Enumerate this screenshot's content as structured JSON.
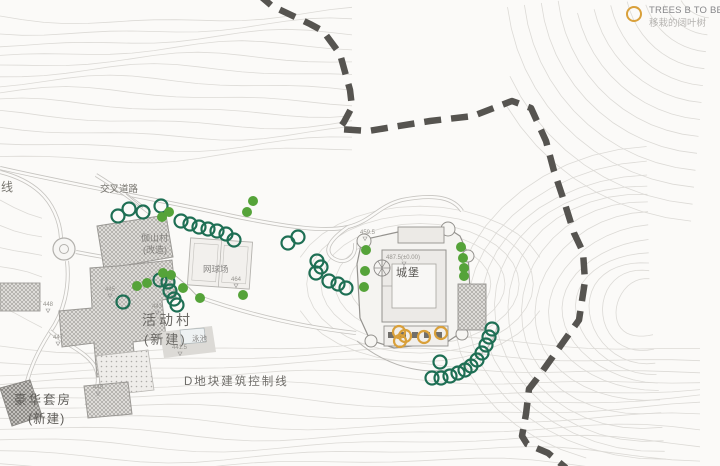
{
  "legend": {
    "tree_move": {
      "label_en": "TREES B TO BE M",
      "label_zh": "移栽的阔叶树"
    }
  },
  "colors": {
    "contour": "#dcdad6",
    "road": "#c6c4c0",
    "road_gap": "#fbfaf8",
    "boundary": "#565450",
    "tree_existing": "#55a339",
    "tree_evergreen": "#1e6f54",
    "tree_move": "#d9a03a",
    "building_stroke": "#9b9995",
    "label_gray": "#8a8886"
  },
  "map": {
    "boundary_points": [
      [
        258,
        -6
      ],
      [
        272,
        6
      ],
      [
        310,
        24
      ],
      [
        323,
        31
      ],
      [
        340,
        54
      ],
      [
        350,
        90
      ],
      [
        352,
        107
      ],
      [
        344,
        122
      ],
      [
        339,
        129
      ],
      [
        368,
        131
      ],
      [
        430,
        121
      ],
      [
        473,
        116
      ],
      [
        512,
        101
      ],
      [
        531,
        108
      ],
      [
        546,
        141
      ],
      [
        554,
        171
      ],
      [
        564,
        201
      ],
      [
        574,
        233
      ],
      [
        583,
        252
      ],
      [
        585,
        281
      ],
      [
        579,
        320
      ],
      [
        559,
        348
      ],
      [
        539,
        376
      ],
      [
        529,
        389
      ],
      [
        526,
        414
      ],
      [
        522,
        436
      ],
      [
        527,
        444
      ],
      [
        548,
        453
      ],
      [
        566,
        468
      ]
    ],
    "trees": {
      "evergreen_kept": [
        [
          118,
          216
        ],
        [
          129,
          209
        ],
        [
          143,
          212
        ],
        [
          161,
          206
        ],
        [
          181,
          221
        ],
        [
          190,
          224
        ],
        [
          199,
          227
        ],
        [
          208,
          229
        ],
        [
          217,
          231
        ],
        [
          226,
          234
        ],
        [
          234,
          240
        ],
        [
          288,
          243
        ],
        [
          298,
          237
        ],
        [
          317,
          261
        ],
        [
          321,
          267
        ],
        [
          316,
          273
        ],
        [
          329,
          281
        ],
        [
          338,
          284
        ],
        [
          346,
          288
        ],
        [
          123,
          302
        ],
        [
          160,
          280
        ],
        [
          168,
          282
        ],
        [
          170,
          291
        ],
        [
          174,
          299
        ],
        [
          177,
          305
        ],
        [
          440,
          362
        ],
        [
          432,
          378
        ],
        [
          441,
          378
        ],
        [
          450,
          376
        ],
        [
          458,
          373
        ],
        [
          465,
          370
        ],
        [
          471,
          366
        ],
        [
          477,
          360
        ],
        [
          482,
          353
        ],
        [
          486,
          345
        ],
        [
          489,
          337
        ],
        [
          492,
          329
        ]
      ],
      "existing_broadleaf": [
        [
          253,
          201
        ],
        [
          247,
          212
        ],
        [
          162,
          217
        ],
        [
          169,
          212
        ],
        [
          137,
          286
        ],
        [
          147,
          283
        ],
        [
          163,
          273
        ],
        [
          171,
          275
        ],
        [
          183,
          288
        ],
        [
          200,
          298
        ],
        [
          243,
          295
        ],
        [
          366,
          250
        ],
        [
          365,
          271
        ],
        [
          364,
          287
        ],
        [
          461,
          247
        ],
        [
          463,
          258
        ],
        [
          464,
          268
        ],
        [
          464,
          276
        ]
      ],
      "to_move": [
        [
          399,
          332
        ],
        [
          405,
          336
        ],
        [
          400,
          341
        ],
        [
          424,
          337
        ],
        [
          441,
          333
        ]
      ],
      "fan_symbol": [
        [
          382,
          268
        ]
      ]
    },
    "labels": [
      {
        "text": "线",
        "x": 1,
        "y": 191,
        "size": 12,
        "color": "#77756f"
      },
      {
        "text": "交叉道路",
        "x": 100,
        "y": 192,
        "size": 9.5,
        "color": "#77756f"
      },
      {
        "text": "伽山村",
        "x": 141,
        "y": 241,
        "size": 9,
        "color": "#85837f"
      },
      {
        "text": "(改造)",
        "x": 143,
        "y": 253,
        "size": 9,
        "color": "#85837f"
      },
      {
        "text": "网球场",
        "x": 203,
        "y": 272,
        "size": 8.5,
        "color": "#8a8886"
      },
      {
        "text": "活动村",
        "x": 142,
        "y": 325,
        "size": 14,
        "ls": 3,
        "color": "#6b6965"
      },
      {
        "text": "(新建)",
        "x": 144,
        "y": 344,
        "size": 13,
        "ls": 2,
        "color": "#6b6965"
      },
      {
        "text": "泳池",
        "x": 192,
        "y": 341,
        "size": 7.5,
        "color": "#8a8886"
      },
      {
        "text": "D地块建筑控制线",
        "x": 184,
        "y": 385,
        "size": 11.5,
        "ls": 2,
        "color": "#6e6c68"
      },
      {
        "text": "豪华套房",
        "x": 14,
        "y": 404,
        "size": 12.5,
        "ls": 2,
        "color": "#5f5d59"
      },
      {
        "text": "(新建)",
        "x": 28,
        "y": 423,
        "size": 12.5,
        "ls": 1,
        "color": "#5f5d59"
      },
      {
        "text": "城堡",
        "x": 396,
        "y": 276,
        "size": 11,
        "ls": 1,
        "color": "#5a5854"
      },
      {
        "text": "487.5(±0.00)",
        "x": 386,
        "y": 259,
        "size": 6,
        "color": "#96948f"
      },
      {
        "text": "459.5",
        "x": 360,
        "y": 234,
        "size": 6,
        "color": "#96948f"
      },
      {
        "text": "445",
        "x": 105,
        "y": 291,
        "size": 6,
        "color": "#96948f"
      },
      {
        "text": "448",
        "x": 43,
        "y": 306,
        "size": 6,
        "color": "#96948f"
      },
      {
        "text": "447",
        "x": 53,
        "y": 339,
        "size": 6,
        "color": "#96948f"
      },
      {
        "text": "448",
        "x": 93,
        "y": 389,
        "size": 6,
        "color": "#96948f"
      },
      {
        "text": "443",
        "x": 152,
        "y": 308,
        "size": 6,
        "color": "#96948f"
      },
      {
        "text": "441.5",
        "x": 172,
        "y": 349,
        "size": 6,
        "color": "#96948f"
      },
      {
        "text": "464",
        "x": 231,
        "y": 281,
        "size": 6,
        "color": "#96948f"
      }
    ],
    "level_markers": [
      [
        108,
        294
      ],
      [
        46,
        309
      ],
      [
        56,
        342
      ],
      [
        96,
        392
      ],
      [
        155,
        311
      ],
      [
        178,
        352
      ],
      [
        234,
        284
      ],
      [
        402,
        262
      ],
      [
        363,
        237
      ]
    ]
  }
}
